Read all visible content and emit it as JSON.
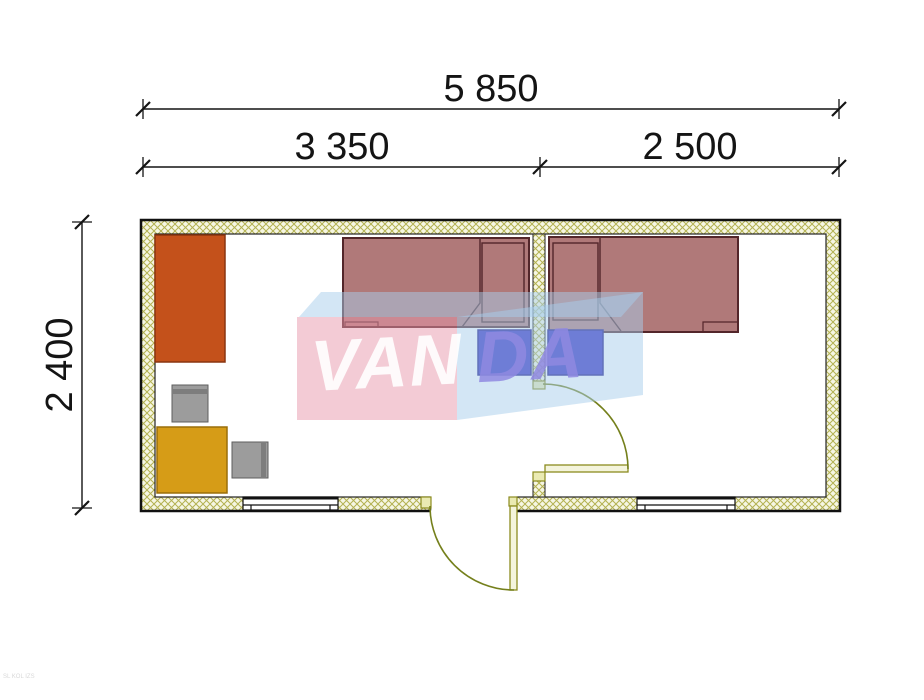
{
  "dimensions": {
    "total_width": "5 850",
    "left_section": "3 350",
    "right_section": "2 500",
    "depth": "2 400"
  },
  "watermark": {
    "part1": "VAN",
    "part2": "DA"
  },
  "corner_note": "SL KOL IZS",
  "colors": {
    "wall_hatch_line": "#b3b151",
    "wall_hatch_bg": "#f6f6e3",
    "wardrobe": "#c4511b",
    "desk": "#d69c17",
    "chair": "#9c9c9c",
    "chair_stripe": "#7d7d7d",
    "bed": "#9c5858",
    "bed_outline": "#53262a",
    "nightstand": "#352cc0",
    "door_leaf": "#f4f4dc",
    "door_stroke": "#8b8b1f",
    "door_arc": "#75801c",
    "jamb": "#eaeab2",
    "watermark_pink": "#e898ac",
    "watermark_blue": "#a8cdec",
    "watermark_text_left": "#ffffff",
    "watermark_text_right": "#8f88e0",
    "dimension_ink": "#141414"
  },
  "furniture": {
    "room_left": [
      "wardrobe",
      "chair",
      "desk",
      "chair",
      "single-bed",
      "nightstand"
    ],
    "room_right": [
      "single-bed",
      "nightstand"
    ]
  }
}
